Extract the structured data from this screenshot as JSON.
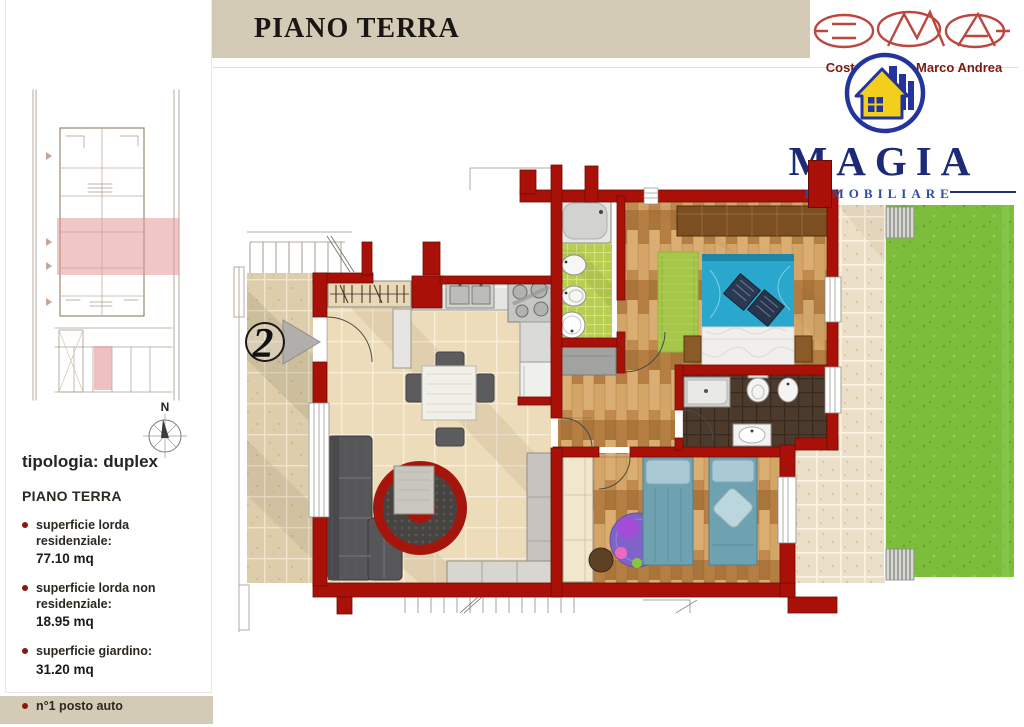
{
  "page": {
    "unit_title": "Unità 2",
    "floor_title": "PIANO TERRA"
  },
  "logo": {
    "company_line": "Costruzioni di Marco Andrea",
    "brand": "MAGIA",
    "brand_subtitle": "IMMOBILIARE"
  },
  "sidebar": {
    "typology": "tipologia: duplex",
    "floor_label": "PIANO TERRA",
    "compass_label": "N",
    "features": [
      {
        "label": "superficie lorda residenziale:",
        "value": "77.10 mq"
      },
      {
        "label": "superficie lorda non residenziale:",
        "value": "18.95 mq"
      },
      {
        "label": "superficie giardino:",
        "value": "31.20 mq"
      },
      {
        "label": "n°1 posto auto",
        "value": ""
      }
    ]
  },
  "plan": {
    "unit_badge": "2"
  },
  "colors": {
    "wall_red": "#a91108",
    "header_bar": "#d4cbb6",
    "garden_green": "#7cbe3c",
    "bathroom_green": "#b7ce52",
    "brand_blue": "#1d2a75",
    "logo_red": "#b5342b",
    "bullet_red": "#8c1710",
    "bed_teal": "#2aa7cd"
  }
}
